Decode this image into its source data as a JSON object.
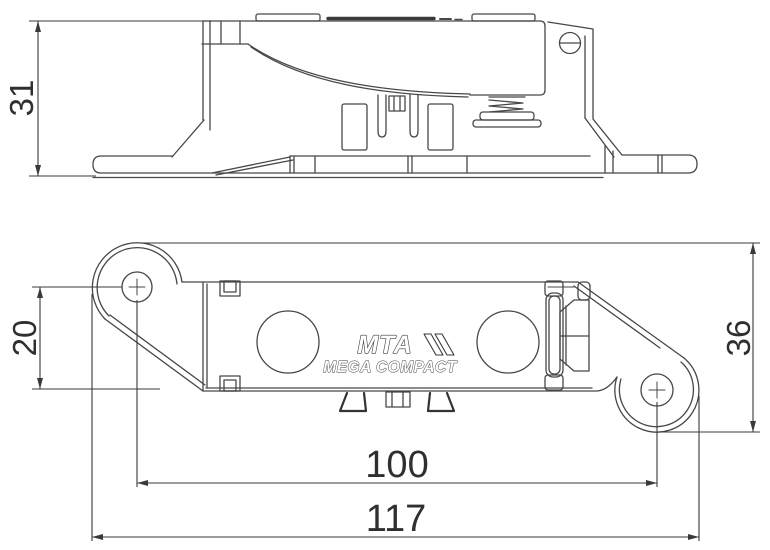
{
  "title": "Technical drawing - fuse holder",
  "logo": {
    "brand": "MTA",
    "product": "MEGA COMPACT"
  },
  "dimensions": {
    "side_height": "31",
    "hole_to_edge": "20",
    "overall_height": "36",
    "hole_spacing": "100",
    "overall_length": "117"
  },
  "colors": {
    "line": "#474747",
    "background": "#ffffff",
    "text": "#2f2f2f"
  }
}
